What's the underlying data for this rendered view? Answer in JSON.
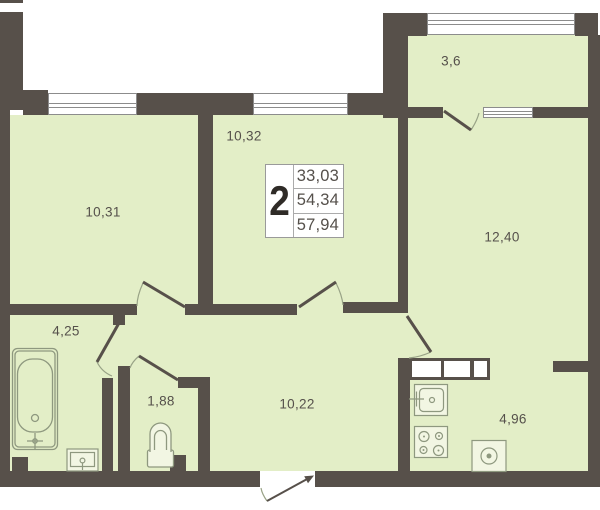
{
  "plan": {
    "type": "apartment-floor-plan",
    "title_box": {
      "room_count": "2",
      "area_line1": "33,03",
      "area_line2": "54,34",
      "area_line3": "57,94"
    },
    "rooms": [
      {
        "id": "room-10-31",
        "label": "10,31"
      },
      {
        "id": "room-10-32",
        "label": "10,32"
      },
      {
        "id": "balcony",
        "label": "3,6"
      },
      {
        "id": "room-12-40",
        "label": "12,40"
      },
      {
        "id": "bathroom",
        "label": "4,25"
      },
      {
        "id": "wc",
        "label": "1,88"
      },
      {
        "id": "hallway",
        "label": "10,22"
      },
      {
        "id": "kitchen",
        "label": "4,96"
      }
    ],
    "colors": {
      "wall": "#57504A",
      "floor": "#E3EEC7",
      "fixture_line": "#8E987F",
      "window_border": "#8C8C8C",
      "label_text": "#55504B"
    }
  }
}
